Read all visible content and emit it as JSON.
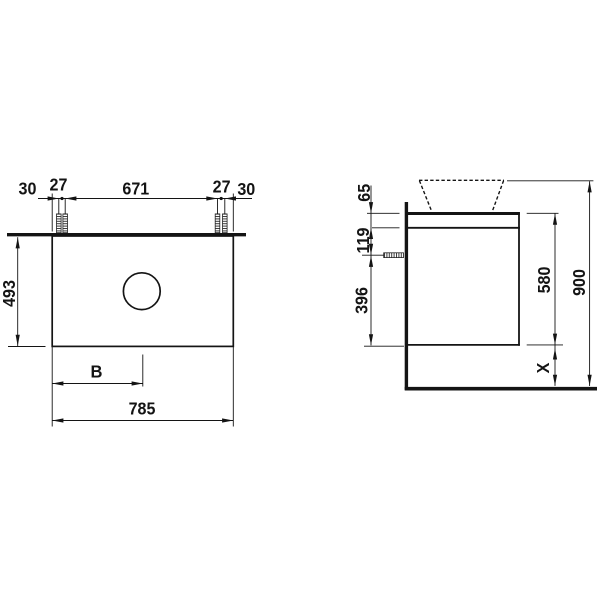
{
  "drawing": {
    "background": "#ffffff",
    "line_color": "#141414"
  },
  "top_view": {
    "edge_to_screw_left": "30",
    "screw_pair_left": "27",
    "screw_to_screw": "671",
    "screw_pair_right": "27",
    "edge_to_screw_right": "30",
    "depth": "493",
    "bowl_position": "B",
    "total_width": "785"
  },
  "side_view": {
    "top_rail_height": "65",
    "screw_drop": "119",
    "screw_to_bottom": "396",
    "cabinet_height": "580",
    "overall_height": "900",
    "floor_clearance": "X"
  }
}
